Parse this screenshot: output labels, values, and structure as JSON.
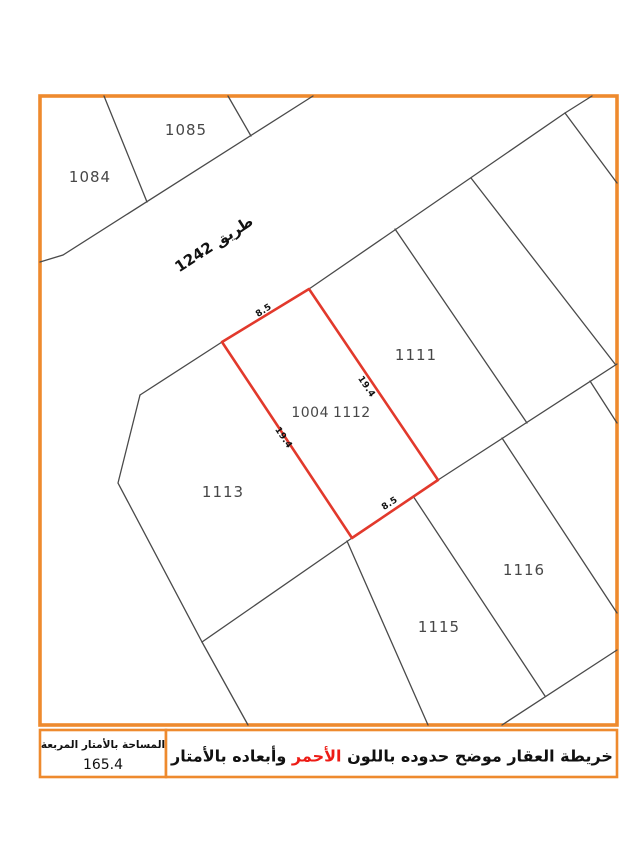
{
  "colors": {
    "frame": "#ee8a2e",
    "parcel_line": "#4a4a4a",
    "subject_outline": "#e2392c",
    "highlight_text": "#ed1c16",
    "label_text": "#474747",
    "annotation_text": "#111111"
  },
  "map": {
    "road": {
      "label": "طريق 1242"
    },
    "parcels": [
      {
        "id": "1084",
        "label": "1084"
      },
      {
        "id": "1085",
        "label": "1085"
      },
      {
        "id": "1111",
        "label": "1111"
      },
      {
        "id": "1113",
        "label": "1113"
      },
      {
        "id": "1115",
        "label": "1115"
      },
      {
        "id": "1116",
        "label": "1116"
      }
    ],
    "subject_parcel": {
      "block_number": "1004",
      "parcel_number": "1112",
      "dimensions_meters": [
        {
          "edge": "northwest",
          "value": "8.5"
        },
        {
          "edge": "northeast",
          "value": "19.4"
        },
        {
          "edge": "southwest",
          "value": "19.4"
        },
        {
          "edge": "southeast",
          "value": "8.5"
        }
      ]
    }
  },
  "footer": {
    "area_box": {
      "title": "المساحة بالأمتار المربعة",
      "value": "165.4"
    },
    "legend": {
      "text_before_highlight": "خريطة العقار موضح حدوده باللون ",
      "highlight_word": "الأحمر",
      "text_after_highlight": " وأبعاده بالأمتار"
    }
  }
}
